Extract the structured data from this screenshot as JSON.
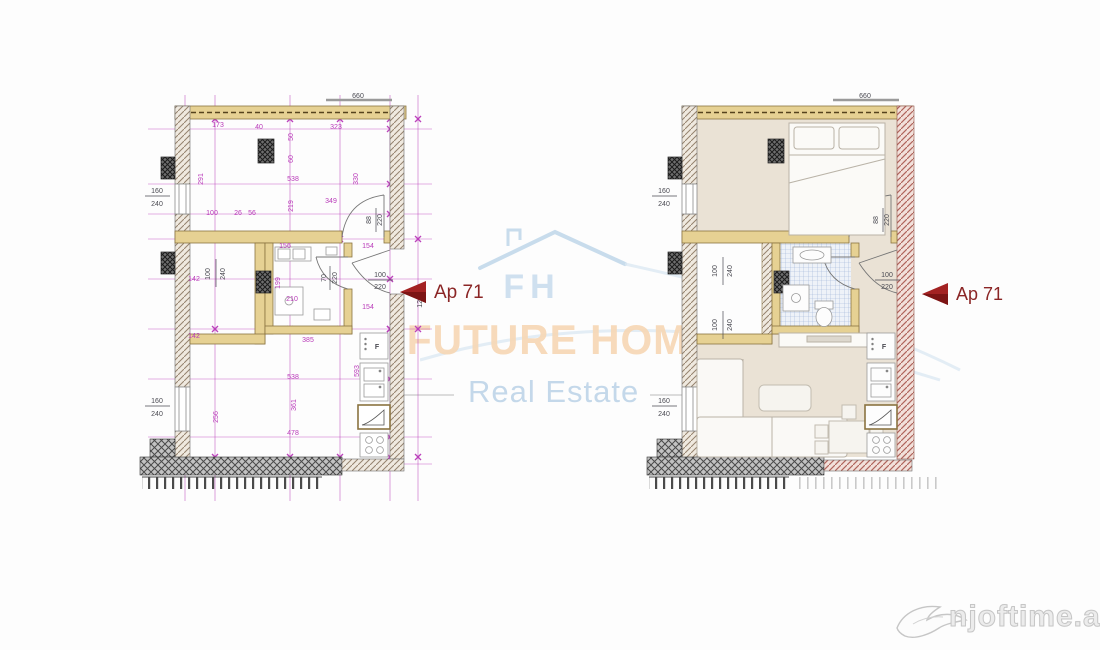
{
  "watermark": {
    "company": "FUTURE HOME",
    "tagline": "Real Estate",
    "monogram": "FH"
  },
  "site_logo": {
    "text": "njoftime.al"
  },
  "apartment_marker": {
    "label": "Ap 71"
  },
  "colors": {
    "dimension": "#b93ab9",
    "label_dark": "#4a4a52",
    "arrow": "#9e1e1e",
    "wall_tan": "#e6d193",
    "floor_beige": "#eae2d5",
    "company_text": "#f7d7b4",
    "tagline_text": "#c2d7e9"
  },
  "left_plan": {
    "name": "technical plan",
    "dims": {
      "top_a": "173",
      "top_b": "40",
      "top_c": "323",
      "top_win": "660",
      "col_a": "50",
      "col_b": "60",
      "v_291": "291",
      "h_538": "538",
      "v_330": "330",
      "v_219": "219",
      "h_349": "349",
      "seg_100": "100",
      "seg_26": "26",
      "seg_56": "56",
      "win_w": "160",
      "win_h": "240",
      "closet_142a": "142",
      "closet_142b": "142",
      "closet_w": "100",
      "closet_h": "240",
      "bath_156": "156",
      "bath_199": "199",
      "bath_210": "210",
      "hall_154a": "154",
      "hall_154b": "154",
      "h_385": "385",
      "h_538b": "538",
      "v_593": "593",
      "v_361": "361",
      "v_256": "256",
      "h_478": "478",
      "side_1285": "1285",
      "door_bed_w": "88",
      "door_bed_h": "220",
      "door_bath_w": "70",
      "door_bath_h": "220",
      "door_entry_w": "100",
      "door_entry_h": "220",
      "fridge": "F"
    }
  },
  "right_plan": {
    "name": "furnished plan",
    "dims": {
      "top_win": "660",
      "win_w": "160",
      "win_h": "240",
      "closet_w": "100",
      "closet_h": "240",
      "closet_w2": "100",
      "closet_h2": "240",
      "door_bed_w": "88",
      "door_bed_h": "220",
      "door_entry_w": "100",
      "door_entry_h": "220",
      "fridge": "F"
    }
  }
}
